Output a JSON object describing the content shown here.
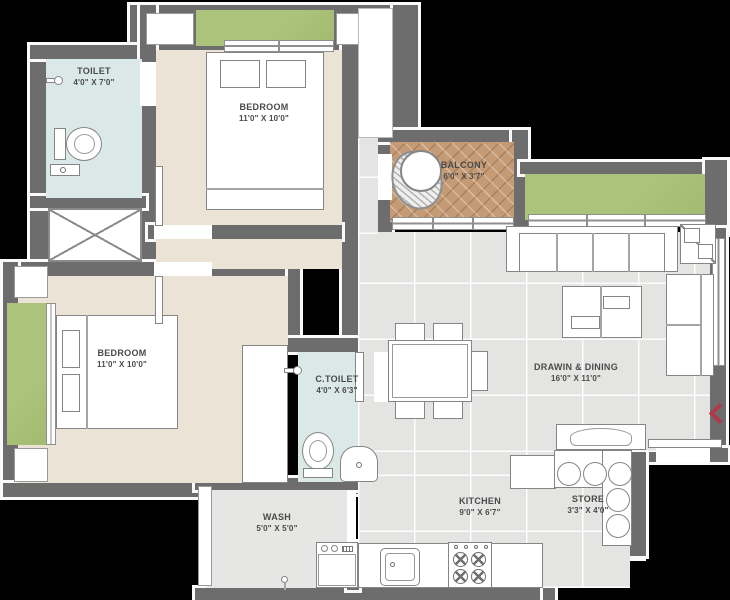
{
  "plan": {
    "type": "residential floor plan",
    "rooms": 9
  },
  "rooms": {
    "toilet": {
      "name": "TOILET",
      "dims": "4'0\" X 7'0\""
    },
    "bedroom1": {
      "name": "BEDROOM",
      "dims": "11'0\" X 10'0\""
    },
    "balcony": {
      "name": "BALCONY",
      "dims": "6'0\" X 3'7\""
    },
    "bedroom2": {
      "name": "BEDROOM",
      "dims": "11'0\" X 10'0\""
    },
    "ctoilet": {
      "name": "C.TOILET",
      "dims": "4'0\" X 6'3\""
    },
    "drawing_dining": {
      "name": "DRAWIN & DINING",
      "dims": "16'0\" X 11'0\""
    },
    "kitchen": {
      "name": "KITCHEN",
      "dims": "9'0\" X 6'7\""
    },
    "store": {
      "name": "STORE",
      "dims": "3'3\" X 4'0\""
    },
    "wash": {
      "name": "WASH",
      "dims": "5'0\" X 5'0\""
    }
  },
  "icons": [
    "entrance-arrow-icon",
    "bed-icon",
    "sofa-icon",
    "coffee-table-icon",
    "dining-table-icon",
    "wc-icon",
    "washbasin-icon",
    "shower-icon",
    "stove-icon",
    "sink-icon",
    "washing-machine-icon",
    "fridge-icon",
    "duct-cross-icon",
    "swing-icon",
    "container-icon",
    "tv-unit-icon",
    "wardrobe-icon"
  ],
  "colors": {
    "background": "#000000",
    "wall": "#6d6d6d",
    "wall_outline": "#fafafa",
    "floor_living": "#e4e4e2",
    "floor_bedroom": "#eae3d6",
    "floor_toilet": "#dae8e8",
    "balcony_tile": "#c49b74",
    "lawn_green": "#a9c177",
    "label_text": "#4a4a4a",
    "entry_arrow": "#b23848"
  }
}
